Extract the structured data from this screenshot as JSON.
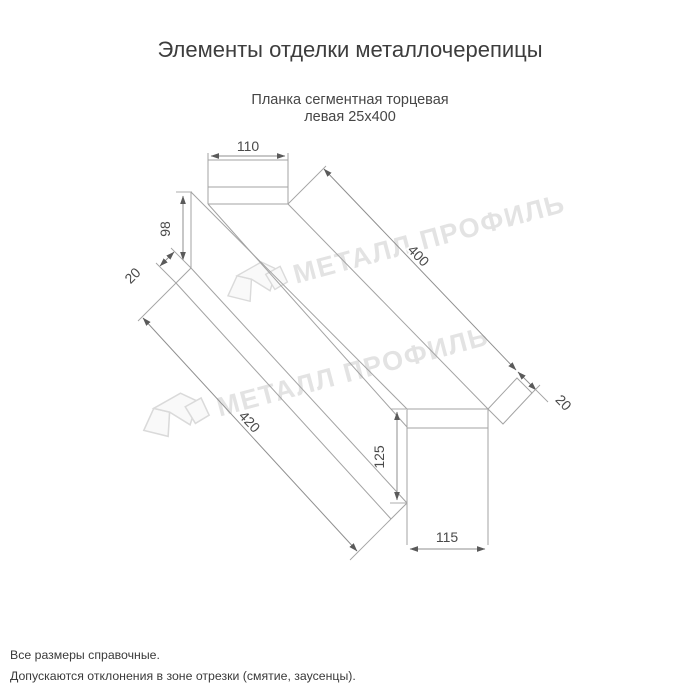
{
  "page": {
    "title": "Элементы отделки металлочерепицы"
  },
  "product": {
    "name_line1": "Планка сегментная торцевая",
    "name_line2": "левая 25х400"
  },
  "dimensions": {
    "flange_width_top": "110",
    "end_height_left": "98",
    "hem_left": "20",
    "length_top": "400",
    "length_bottom": "420",
    "end_face_height": "125",
    "end_face_width": "115",
    "hem_right": "20"
  },
  "watermark": {
    "text": "МЕТАЛЛ ПРОФИЛЬ"
  },
  "footer": {
    "line1": "Все размеры справочные.",
    "line2": "Допускаются отклонения в зоне отрезки (смятие, заусенцы)."
  },
  "colors": {
    "drawing_line": "#a3a3a3",
    "dimension_text": "#4a4a4a",
    "title_text": "#3d3d3d",
    "watermark": "#e3e3e3",
    "background": "#ffffff"
  }
}
